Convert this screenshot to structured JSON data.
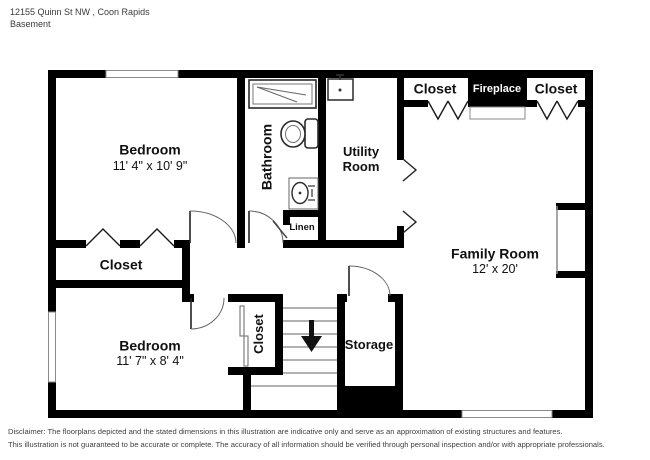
{
  "header": {
    "address": "12155 Quinn St NW , Coon Rapids",
    "floor": "Basement"
  },
  "rooms": {
    "bedroom1": {
      "name": "Bedroom",
      "dims": "11' 4\" x 10' 9\""
    },
    "bathroom": {
      "name": "Bathroom"
    },
    "utility": {
      "line1": "Utility",
      "line2": "Room"
    },
    "closet_top_left": {
      "name": "Closet"
    },
    "fireplace": {
      "name": "Fireplace"
    },
    "closet_top_right": {
      "name": "Closet"
    },
    "family": {
      "name": "Family Room",
      "dims": "12' x 20'"
    },
    "closet_hall": {
      "name": "Closet"
    },
    "linen": {
      "name": "Linen"
    },
    "bedroom2": {
      "name": "Bedroom",
      "dims": "11' 7\" x 8' 4\""
    },
    "closet_bedroom2": {
      "name": "Closet"
    },
    "storage": {
      "name": "Storage"
    }
  },
  "disclaimer": {
    "line1": "Disclaimer: The floorplans depicted and the stated dimensions in this illustration are indicative only and serve as an approximation of existing structures and features.",
    "line2": "This illustration is not guaranteed to be accurate or complete. The accuracy of all information should be verified through personal inspection and/or with appropriate professionals."
  },
  "colors": {
    "wall": "#000000",
    "fireplace_bg": "#000000",
    "fireplace_text": "#ffffff",
    "thin_line": "#8a8a8a"
  }
}
